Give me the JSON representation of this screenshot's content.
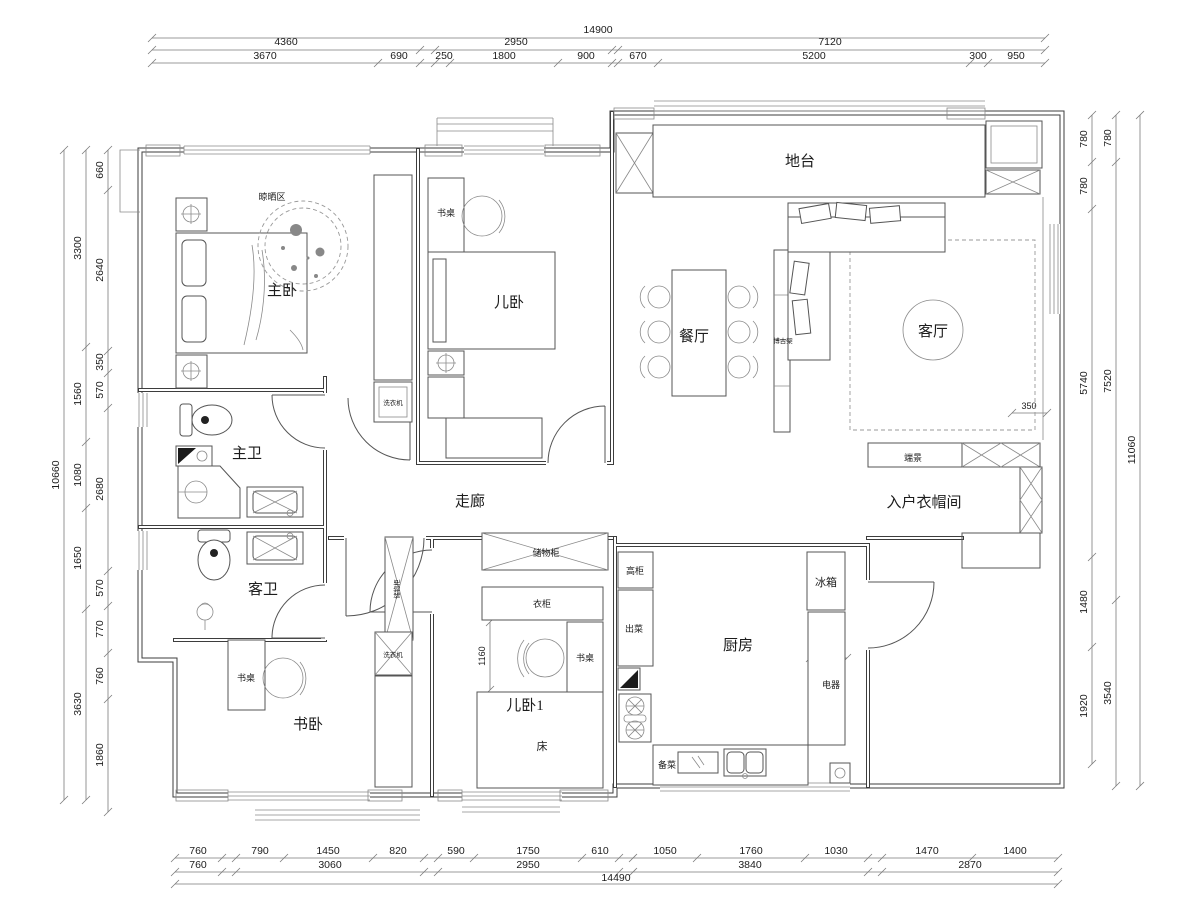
{
  "dims": {
    "top": {
      "total": "14900",
      "row2": [
        "4360",
        "2950",
        "7120"
      ],
      "row3": [
        "3670",
        "690",
        "250",
        "1800",
        "900",
        "670",
        "5200",
        "300",
        "950"
      ]
    },
    "bottom": {
      "row1": [
        "760",
        "790",
        "1450",
        "820",
        "590",
        "1750",
        "610",
        "1050",
        "1760",
        "1030",
        "1470",
        "1400"
      ],
      "row2": [
        "760",
        "3060",
        "2950",
        "3840",
        "2870"
      ],
      "total": "14490"
    },
    "left": {
      "outer": "10660",
      "middle": [
        "3300",
        "1560",
        "1080",
        "1650",
        "3630"
      ],
      "inner": [
        "660",
        "2640",
        "350",
        "570",
        "2680",
        "570",
        "770",
        "760",
        "1860"
      ]
    },
    "right": {
      "outer": "11060",
      "middle": [
        "780",
        "7520",
        "3540"
      ],
      "inner": [
        "780",
        "780",
        "5740",
        "1480",
        "1920"
      ]
    },
    "inline": {
      "living_gap": "350",
      "appliance_depth": "600",
      "desk_width": "1160"
    }
  },
  "rooms": {
    "master_bedroom": "主卧",
    "drying_area": "晾晒区",
    "kids_bedroom": "儿卧",
    "kids_desk": "书桌",
    "platform": "地台",
    "dining": "餐厅",
    "display_shelf": "博古架",
    "living": "客厅",
    "master_bath": "主卫",
    "corridor": "走廊",
    "entry_cloakroom": "入户衣帽间",
    "end_view": "端景",
    "guest_bath": "客卫",
    "storage_corridor": "储物柜",
    "storage_kids1": "储物柜",
    "tall_cabinet": "高柜",
    "fridge": "冰箱",
    "wardrobe": "衣柜",
    "serving": "出菜",
    "kitchen": "厨房",
    "appliances": "电器",
    "kids1_desk": "书桌",
    "study_desk": "书桌",
    "kids_bedroom1": "儿卧1",
    "study_bedroom": "书卧",
    "bed": "床",
    "prep": "备菜",
    "washer_master": "洗衣机",
    "washer_study": "洗衣机"
  }
}
